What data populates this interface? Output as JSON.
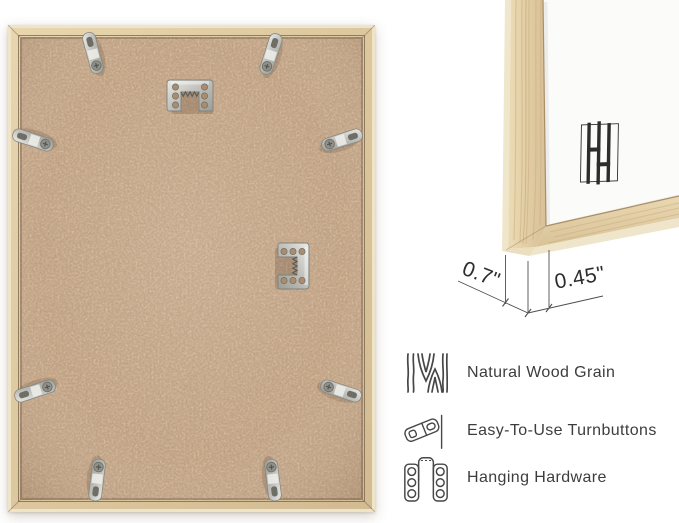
{
  "dimensions": {
    "frame_depth": "0.7\"",
    "frame_face_width": "0.45\""
  },
  "features": {
    "items": [
      {
        "icon": "wood-grain-icon",
        "label": "Natural Wood Grain"
      },
      {
        "icon": "turnbutton-icon",
        "label": "Easy-To-Use Turnbuttons"
      },
      {
        "icon": "hanging-hardware-icon",
        "label": "Hanging Hardware"
      }
    ]
  },
  "back_view": {
    "turnbutton_count": 8,
    "sawtooth_hanger_count": 2
  },
  "brand": {
    "logo_icon": "hh-monogram-logo-icon"
  },
  "colors": {
    "background": "#ffffff",
    "wood_frame": "#e0cba3",
    "mdf_backing": "#c7a686",
    "metal_hardware": "#c6c6c2",
    "text": "#3d3d3d",
    "dimension_lines": "#4f4f4f"
  }
}
